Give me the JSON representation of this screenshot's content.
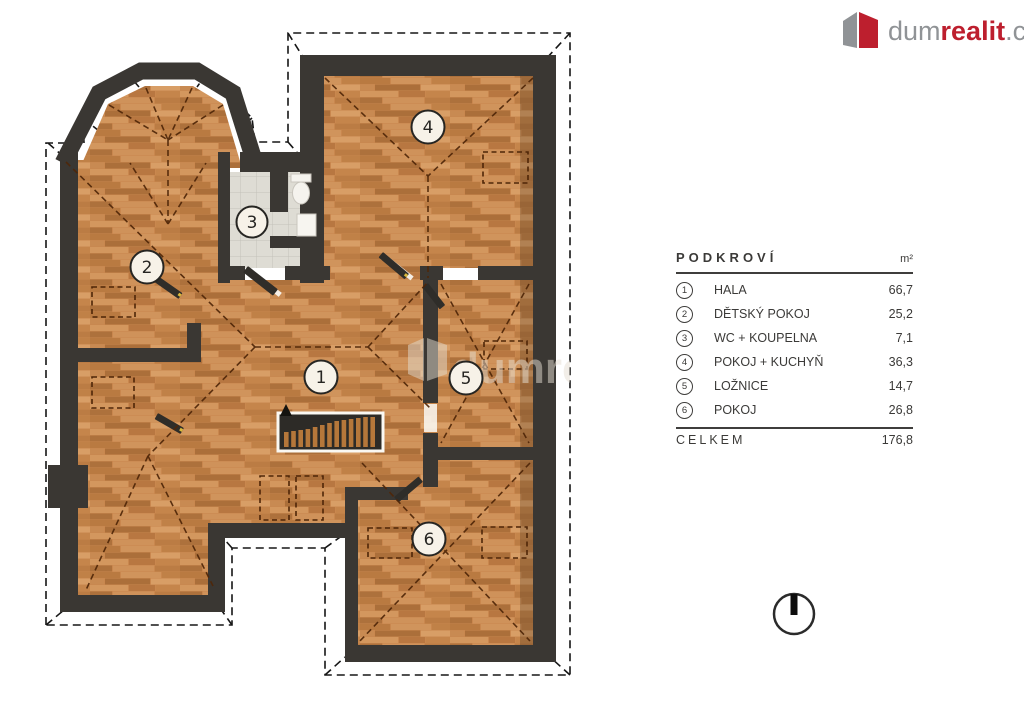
{
  "logo": {
    "gray": "dum",
    "red": "realit",
    "suffix": ".cz"
  },
  "legend": {
    "title": "PODKROVÍ",
    "unit": "m²",
    "rows": [
      {
        "num": "1",
        "label": "HALA",
        "value": "66,7"
      },
      {
        "num": "2",
        "label": "DĚTSKÝ POKOJ",
        "value": "25,2"
      },
      {
        "num": "3",
        "label": "WC + KOUPELNA",
        "value": "7,1"
      },
      {
        "num": "4",
        "label": "POKOJ + KUCHYŇ",
        "value": "36,3"
      },
      {
        "num": "5",
        "label": "LOŽNICE",
        "value": "14,7"
      },
      {
        "num": "6",
        "label": "POKOJ",
        "value": "26,8"
      }
    ],
    "total_label": "CELKEM",
    "total_value": "176,8"
  },
  "plan": {
    "room_numbers": [
      "1",
      "2",
      "3",
      "4",
      "5",
      "6"
    ],
    "watermark_text": "dumrea"
  },
  "colors": {
    "wall": "#3a3733",
    "wood": "#c9874e",
    "tile": "#dedcd4",
    "brand_red": "#bd1f2e",
    "brand_gray": "#909396",
    "hip_dash": "#4f2608"
  }
}
